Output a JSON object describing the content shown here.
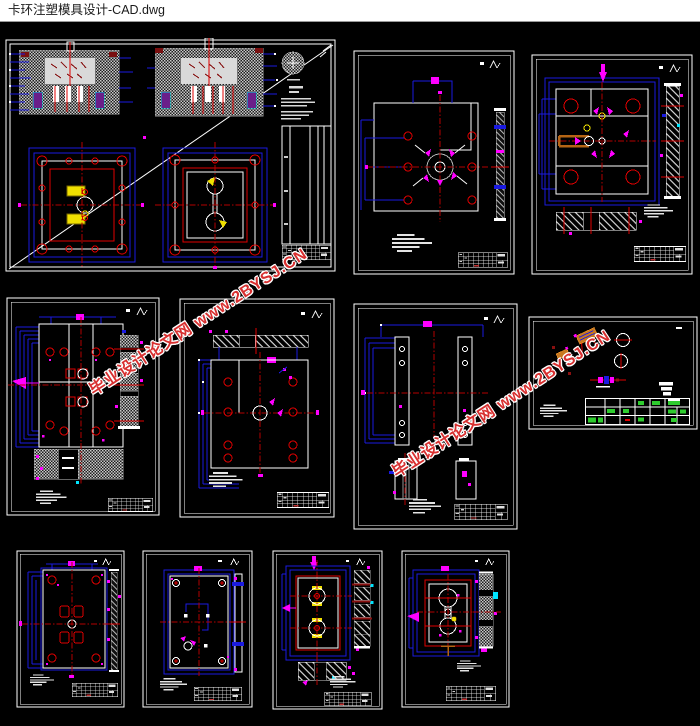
{
  "window": {
    "title": "卡环注塑模具设计-CAD.dwg"
  },
  "watermark": {
    "text": "毕业设计论文网 www.2BYSJ.CN"
  },
  "colors": {
    "canvas": "#000000",
    "titlebar_bg": "#ffffff",
    "titlebar_text": "#1a1a1a",
    "cad_blue": "#1a1ae0",
    "cad_red": "#e00000",
    "centerline_red": "#b40000",
    "magenta": "#ff00ff",
    "cyan": "#00e5ff",
    "yellow": "#f0e000",
    "green": "#2ecc2e",
    "white_line": "#ffffff",
    "hatch_gray": "#b8b8b8",
    "orange": "#c87820",
    "watermark_red": "#d83030"
  }
}
